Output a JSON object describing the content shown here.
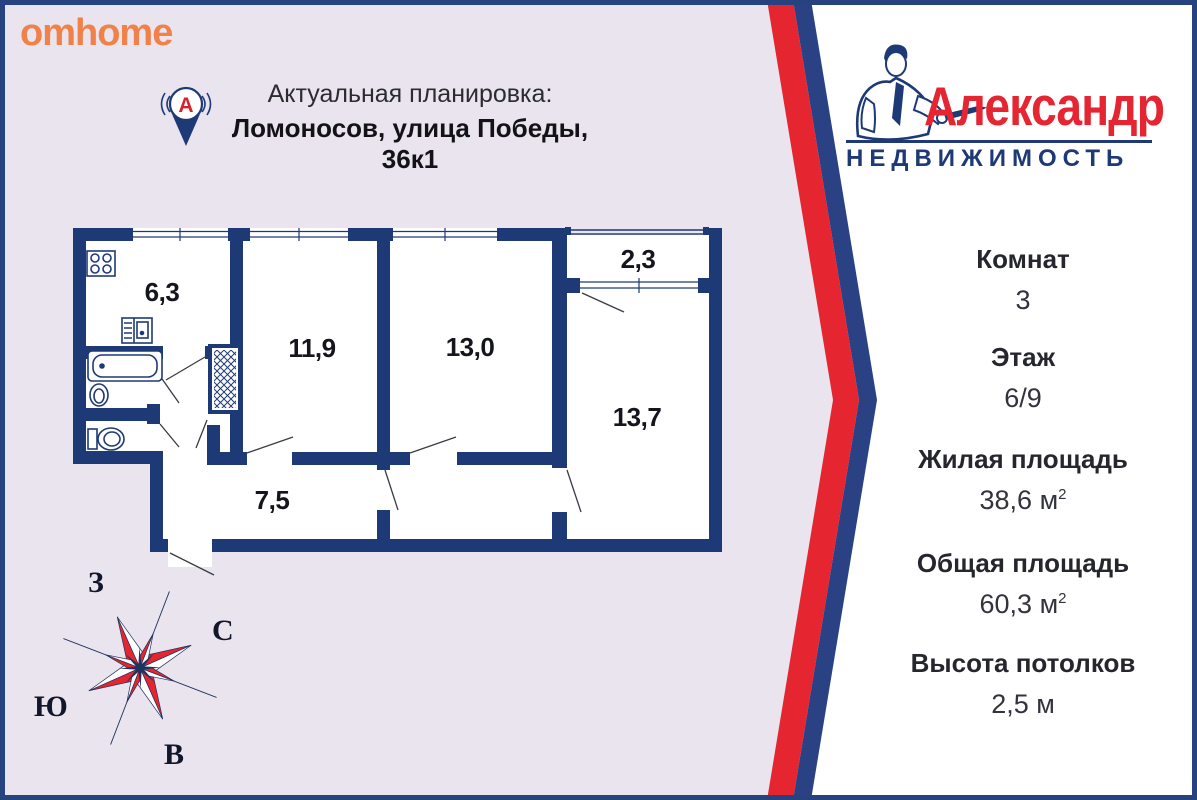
{
  "branding": {
    "site_logo": "omhome",
    "agency_name": "Александр",
    "agency_subtitle": "НЕДВИЖИМОСТЬ",
    "pin_letter": "А"
  },
  "header": {
    "title": "Актуальная планировка:",
    "address": "Ломоносов, улица Победы, 36к1"
  },
  "floor_plan": {
    "room_labels": {
      "kitchen": "6,3",
      "room_small": "11,9",
      "room_mid": "13,0",
      "balcony": "2,3",
      "room_large": "13,7",
      "hallway": "7,5"
    }
  },
  "compass": {
    "west": "З",
    "north": "С",
    "south": "Ю",
    "east": "В"
  },
  "details": {
    "rooms_label": "Комнат",
    "rooms_value": "3",
    "floor_label": "Этаж",
    "floor_value": "6/9",
    "living_label": "Жилая площадь",
    "living_value": "38,6 м",
    "living_sup": "2",
    "total_label": "Общая площадь",
    "total_value": "60,3 м",
    "total_sup": "2",
    "ceiling_label": "Высота потолков",
    "ceiling_value": "2,5 м"
  },
  "colors": {
    "navy": "#1e3a76",
    "red": "#e52530",
    "lavender": "#e9e4ed",
    "orange": "#f08148",
    "white": "#ffffff"
  }
}
